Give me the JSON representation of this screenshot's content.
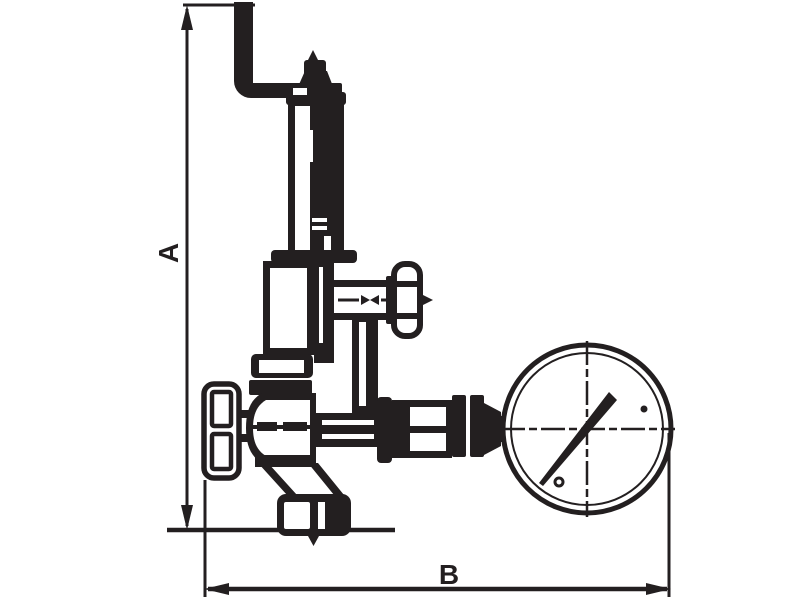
{
  "drawing": {
    "background_color": "#ffffff",
    "ink_color": "#231f20",
    "dimensions": {
      "vertical": {
        "label": "A"
      },
      "horizontal": {
        "label": "B"
      }
    },
    "gauge": {
      "needle_angle_deg": 51,
      "marker_dots": 2,
      "crosshair_style": "dash-dot"
    }
  }
}
